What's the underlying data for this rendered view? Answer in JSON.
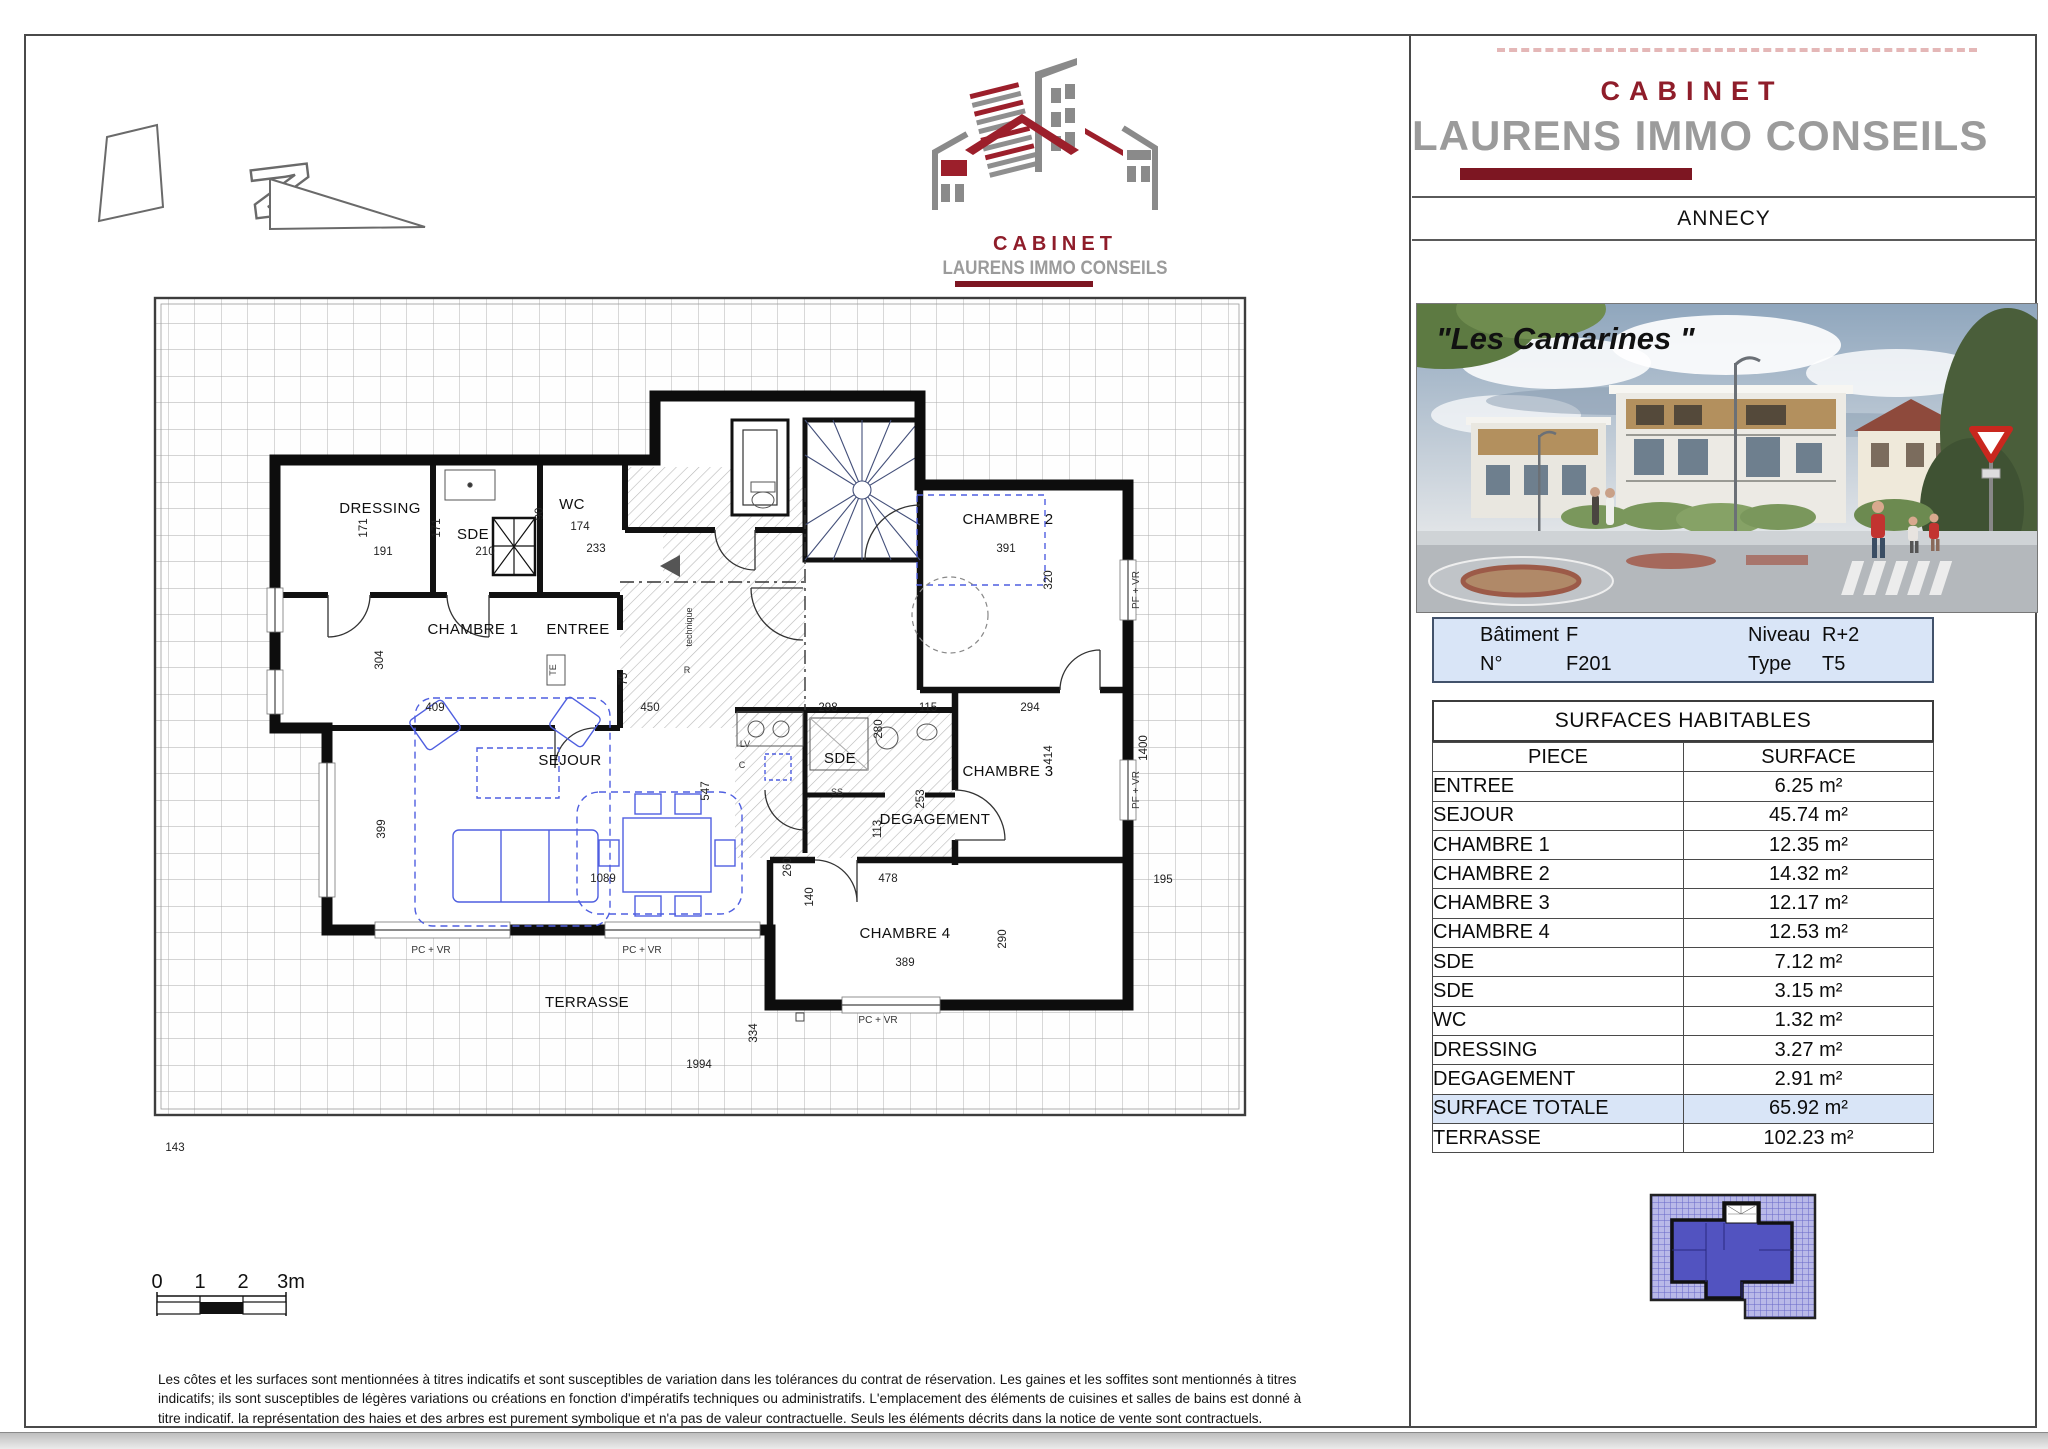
{
  "panel": {
    "brand_line1": "CABINET",
    "brand_line2": "LAURENS IMMO CONSEILS",
    "city": "ANNECY",
    "photo_caption": "\"Les Camarines \"",
    "info": {
      "batiment_label": "Bâtiment",
      "batiment_value": "F",
      "niveau_label": "Niveau",
      "niveau_value": "R+2",
      "numero_label": "N°",
      "numero_value": "F201",
      "type_label": "Type",
      "type_value": "T5"
    },
    "surfaces_title": "SURFACES HABITABLES",
    "table": {
      "col_piece": "PIECE",
      "col_surface": "SURFACE",
      "rows": [
        {
          "piece": "ENTREE",
          "surface": "6.25 m²"
        },
        {
          "piece": "SEJOUR",
          "surface": "45.74 m²"
        },
        {
          "piece": "CHAMBRE 1",
          "surface": "12.35 m²"
        },
        {
          "piece": "CHAMBRE 2",
          "surface": "14.32 m²"
        },
        {
          "piece": "CHAMBRE 3",
          "surface": "12.17 m²"
        },
        {
          "piece": "CHAMBRE 4",
          "surface": "12.53 m²"
        },
        {
          "piece": "SDE",
          "surface": "7.12 m²"
        },
        {
          "piece": "SDE",
          "surface": "3.15 m²"
        },
        {
          "piece": "WC",
          "surface": "1.32 m²"
        },
        {
          "piece": "DRESSING",
          "surface": "3.27 m²"
        },
        {
          "piece": "DEGAGEMENT",
          "surface": "2.91 m²"
        },
        {
          "piece": "SURFACE TOTALE",
          "surface": "65.92 m²"
        },
        {
          "piece": "TERRASSE",
          "surface": "102.23 m²"
        }
      ]
    }
  },
  "logo": {
    "brand_line1": "CABINET",
    "brand_line2": "LAURENS IMMO CONSEILS"
  },
  "plan": {
    "north": "N",
    "rooms": [
      "DRESSING",
      "SDE",
      "WC",
      "CHAMBRE 1",
      "ENTREE",
      "CHAMBRE 2",
      "CHAMBRE 3",
      "SDE",
      "DEGAGEMENT",
      "SEJOUR",
      "CHAMBRE 4",
      "TERRASSE"
    ],
    "dims": [
      "171",
      "191",
      "171",
      "210",
      "90",
      "174",
      "233",
      "304",
      "409",
      "450",
      "75",
      "391",
      "320",
      "294",
      "414",
      "1400",
      "115",
      "280",
      "298",
      "547",
      "253",
      "113",
      "399",
      "1089",
      "260",
      "140",
      "478",
      "389",
      "290",
      "195",
      "334",
      "1994",
      "143"
    ],
    "win_labels": [
      "PC + VR",
      "PC + VR",
      "PC + VR",
      "PF + VR",
      "PF + VR"
    ],
    "fixtures": [
      "TE",
      "technique",
      "R",
      "LV",
      "C",
      "SS"
    ],
    "scale_labels": [
      "0",
      "1",
      "2",
      "3m"
    ]
  },
  "disclaimer": {
    "line1": "Les côtes et les surfaces sont mentionnées à titres indicatifs et sont susceptibles de variation dans les tolérances du contrat de réservation. Les gaines et les soffites sont mentionnés à titres",
    "line2": "indicatifs; ils sont susceptibles de légères variations ou créations en fonction d'impératifs techniques ou administratifs. L'emplacement des éléments de cuisines et salles de bains est donné à",
    "line3": "titre indicatif. la représentation des haies et des arbres est purement symbolique et n'a pas de valeur contractuelle. Seuls les éléments décrits dans la notice de vente sont contractuels."
  },
  "colors": {
    "accent_red": "#8f1d2a",
    "bar_red": "#7d1622",
    "logo_gray": "#9b9b9b",
    "info_blue": "#d9e5f7",
    "furniture_blue": "#4f5fe0"
  }
}
